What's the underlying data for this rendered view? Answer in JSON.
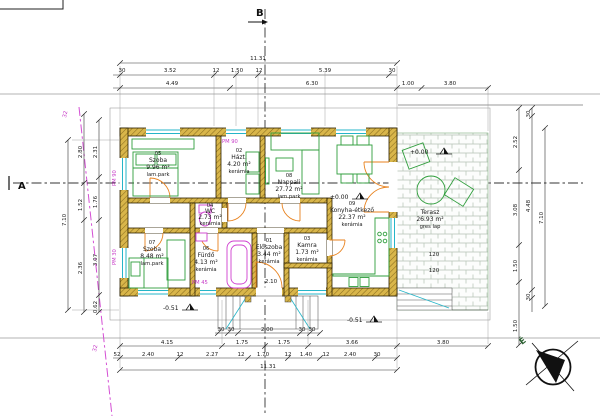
{
  "markers": {
    "section_a": "A",
    "section_b": "B",
    "north": "É"
  },
  "rooms": [
    {
      "num": "05",
      "name": "Szoba",
      "area": "9.96 m²",
      "floor": "lam.park"
    },
    {
      "num": "02",
      "name": "Házt.",
      "area": "4.20 m²",
      "floor": "kerámia"
    },
    {
      "num": "08",
      "name": "Nappali",
      "area": "27.72 m²",
      "floor": "lam.park"
    },
    {
      "num": "09",
      "name": "Konyha-étkező",
      "area": "22.37 m²",
      "floor": "kerámia"
    },
    {
      "num": "04",
      "name": "WC",
      "area": "2.73 m²",
      "floor": "kerámia"
    },
    {
      "num": "07",
      "name": "Szoba",
      "area": "8.48 m²",
      "floor": "lam.park"
    },
    {
      "num": "06",
      "name": "Fürdő",
      "area": "4.13 m²",
      "floor": "kerámia"
    },
    {
      "num": "01",
      "name": "Előszoba",
      "area": "3.44 m²",
      "floor": "kerámia"
    },
    {
      "num": "03",
      "name": "Kamra",
      "area": "1.73 m²",
      "floor": "kerámia"
    },
    {
      "num": "",
      "name": "Terasz",
      "area": "26.93 m²",
      "floor": "gres lap"
    }
  ],
  "levels": {
    "terrace": "+0.00",
    "kitchen": "±0.00",
    "front": "-0.51",
    "right": "-0.51"
  },
  "pm_labels": {
    "top": "PM 90",
    "left_upper": "PM 90",
    "left_lower": "PM 30",
    "bottom": "PM 45"
  },
  "boundary_label": "32",
  "dims": {
    "top": {
      "total": "11.31",
      "row2": [
        "30",
        "3.52",
        "12",
        "1.50",
        "12",
        "5.39",
        "30"
      ],
      "row3": [
        "4.49",
        "6.30"
      ],
      "right": [
        "1.00",
        "3.80"
      ]
    },
    "bottom": {
      "steps": [
        "30",
        "30",
        "2.00",
        "30",
        "30"
      ],
      "row1": [
        "4.15",
        "1.75",
        "1.75",
        "3.66",
        "3.80"
      ],
      "row2": [
        "52",
        "2.40",
        "12",
        "2.27",
        "12",
        "1.70",
        "12",
        "1.40",
        "12",
        "2.40",
        "30"
      ],
      "total": "11.31"
    },
    "left": {
      "total": "7.10",
      "chain_a": [
        "2.80",
        "1.52",
        "2.36"
      ],
      "chain_b": [
        "2.31",
        "1.76",
        "3.07",
        "0.62"
      ]
    },
    "right": {
      "total": "7.10",
      "chain": [
        "2.52",
        "3.08",
        "1.50"
      ],
      "inner": [
        "30",
        "4.48",
        "30"
      ],
      "below": "1.50",
      "extras": [
        "120",
        "120"
      ]
    },
    "misc": {
      "door": "2.10"
    }
  }
}
